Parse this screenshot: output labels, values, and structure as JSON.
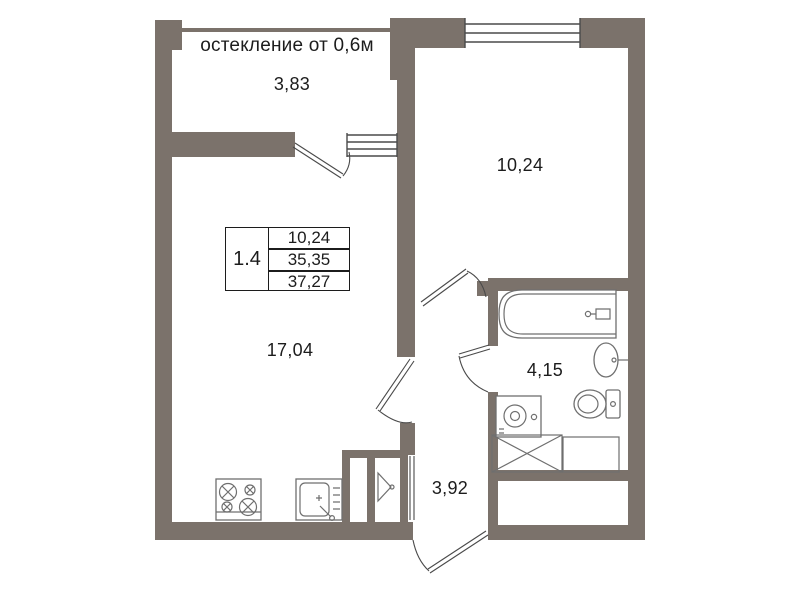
{
  "document_type": "apartment-floor-plan",
  "labels": {
    "glazing": "остекление от 0,6м",
    "balcony_area": "3,83",
    "bedroom_area": "10,24",
    "living_area": "17,04",
    "bathroom_area": "4,15",
    "hallway_area": "3,92"
  },
  "info_table": {
    "unit": "1.4",
    "rows": [
      "10,24",
      "35,35",
      "37,27"
    ]
  },
  "fixtures": [
    "stove",
    "kitchen-sink",
    "bathtub",
    "bathroom-sink",
    "toilet",
    "washing-machine",
    "wardrobe",
    "storage-niche",
    "duct-marker"
  ],
  "colors": {
    "wall": "#7b726b",
    "line": "#4a4a4a",
    "fixture": "#6f6f6f",
    "text": "#1c1c1c",
    "bg": "#ffffff"
  }
}
